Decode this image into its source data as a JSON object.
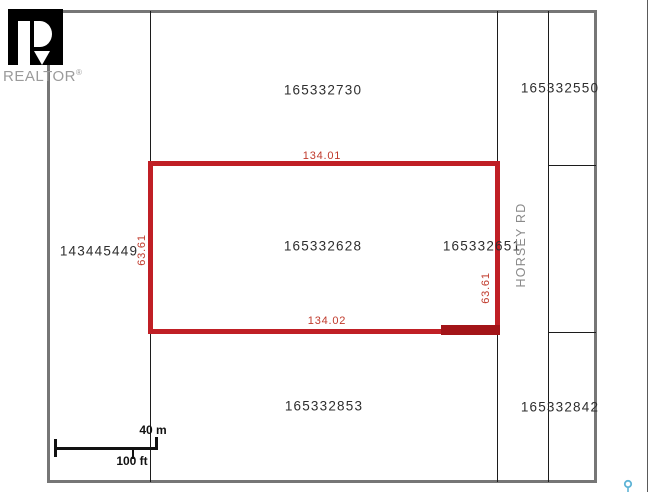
{
  "branding": {
    "logo_text": "REALTOR",
    "registered_mark": "®"
  },
  "map": {
    "parcels": {
      "top_center": "165332730",
      "top_right": "165332550",
      "left": "143445449",
      "highlighted": "165332628",
      "right_of_highlighted": "165332651",
      "bottom_center": "165332853",
      "bottom_right": "165332842"
    },
    "road": {
      "name": "HORSEY RD"
    },
    "highlight_dimensions": {
      "top": "134.01",
      "bottom": "134.02",
      "left": "63.61",
      "right": "63.61"
    },
    "scale_bar": {
      "metric": "40 m",
      "imperial": "100 ft"
    },
    "colors": {
      "highlight": "#c01f25",
      "highlight_overlap": "#a31418",
      "outer_border": "#767676",
      "parcel_line": "#1c1c1c",
      "road_label": "#8a8a8a",
      "logo_gray": "#9b9b9b",
      "pin_teal": "#5fb4d6"
    }
  }
}
